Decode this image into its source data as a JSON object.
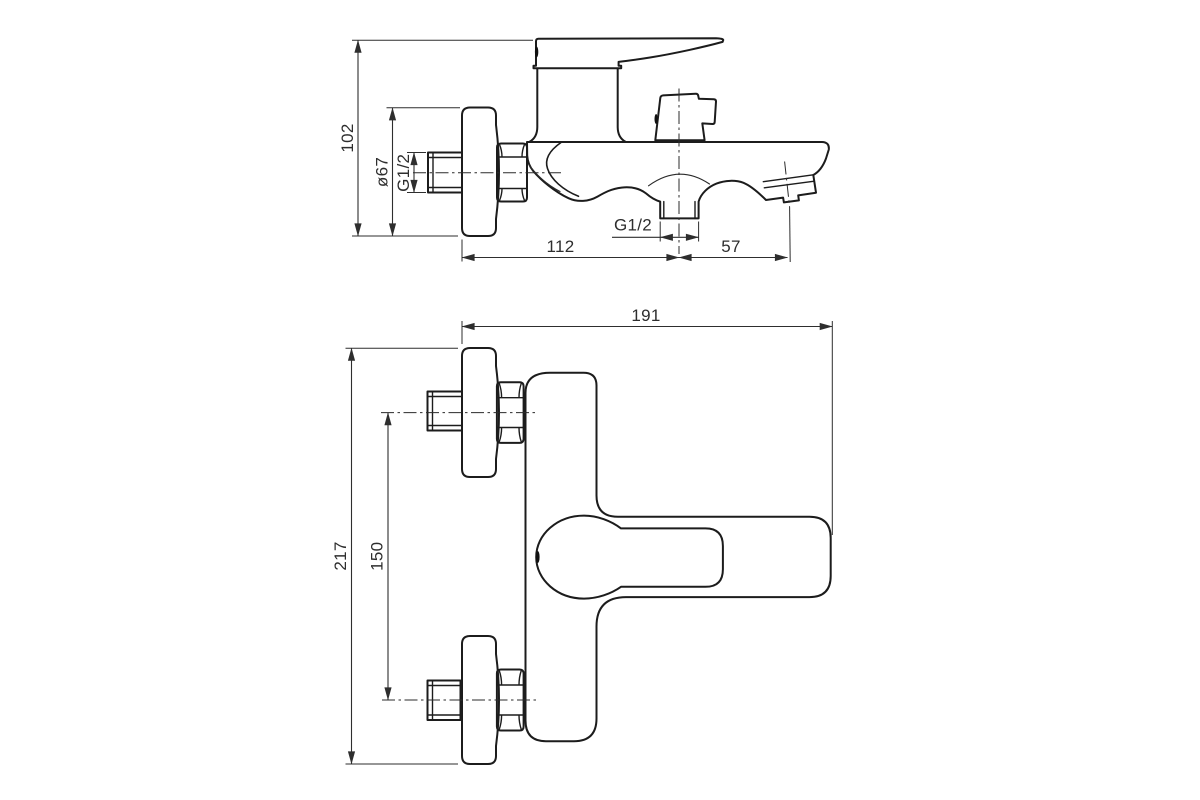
{
  "background": "#ffffff",
  "ink": {
    "object_line": "#1c1c1c",
    "dimension_line": "#2e2e2e",
    "label_text": "#2e2e2e"
  },
  "side_view": {
    "overall_height": "102",
    "flange_diameter": "ø67",
    "inlet_thread": "G1/2",
    "wall_to_outlet": "112",
    "outlet_to_spout": "57",
    "outlet_thread": "G1/2"
  },
  "top_view": {
    "overall_depth": "191",
    "overall_width": "217",
    "inlet_spacing": "150"
  }
}
